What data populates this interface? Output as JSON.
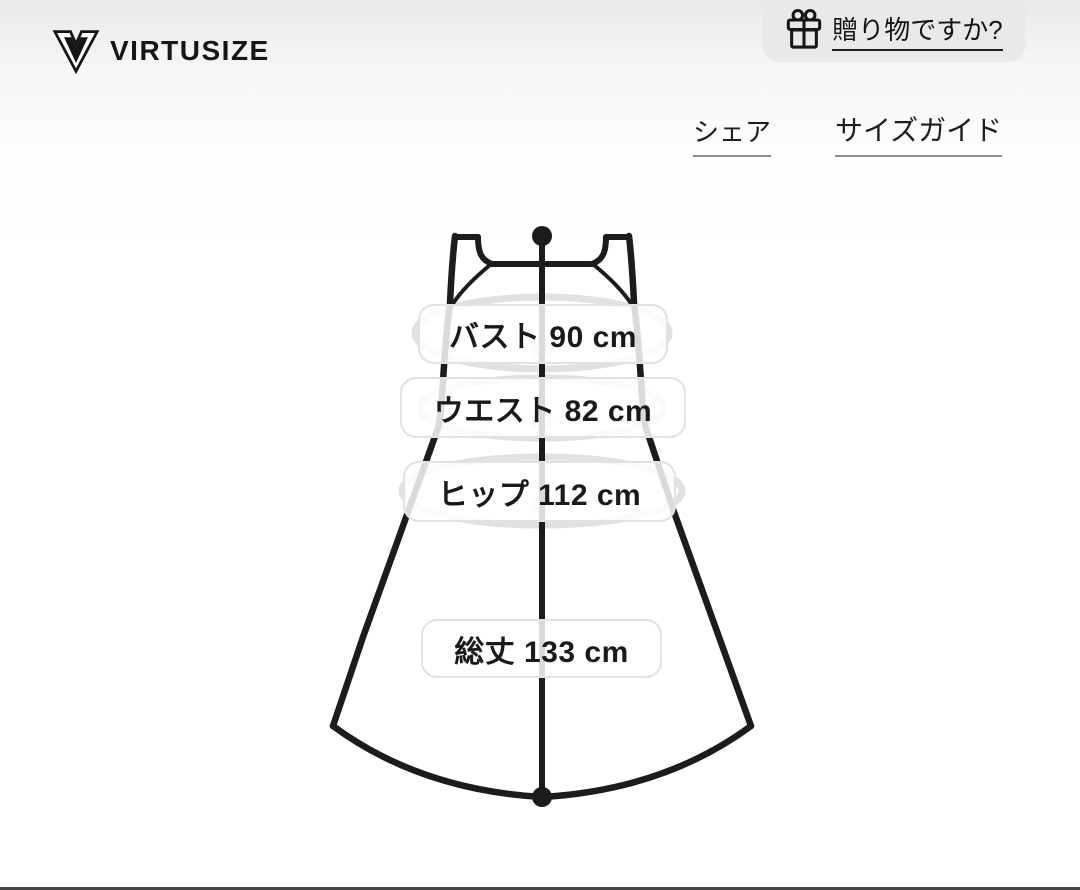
{
  "header": {
    "brand": "VIRTUSIZE",
    "gift_question": "贈り物ですか?",
    "share_label": "シェア",
    "size_guide_label": "サイズガイド"
  },
  "garment": {
    "type": "sleeveless-dress-silhouette",
    "measurements": [
      {
        "name": "バスト",
        "value": 90,
        "unit": "cm",
        "label": "バスト 90 cm"
      },
      {
        "name": "ウエスト",
        "value": 82,
        "unit": "cm",
        "label": "ウエスト 82 cm"
      },
      {
        "name": "ヒップ",
        "value": 112,
        "unit": "cm",
        "label": "ヒップ 112 cm"
      },
      {
        "name": "総丈",
        "value": 133,
        "unit": "cm",
        "label": "総丈 133 cm"
      }
    ]
  },
  "icons": {
    "logo": "virtusize-v-logo",
    "gift": "gift-box-with-bow"
  },
  "colors": {
    "line": "#1c1c1c",
    "measure_ring": "#e1e1e1",
    "pill_border": "#e2e2e2",
    "button_bg": "#e9e9e9",
    "underline_gray": "#8f8f8f",
    "bottom_bar": "#454545"
  }
}
